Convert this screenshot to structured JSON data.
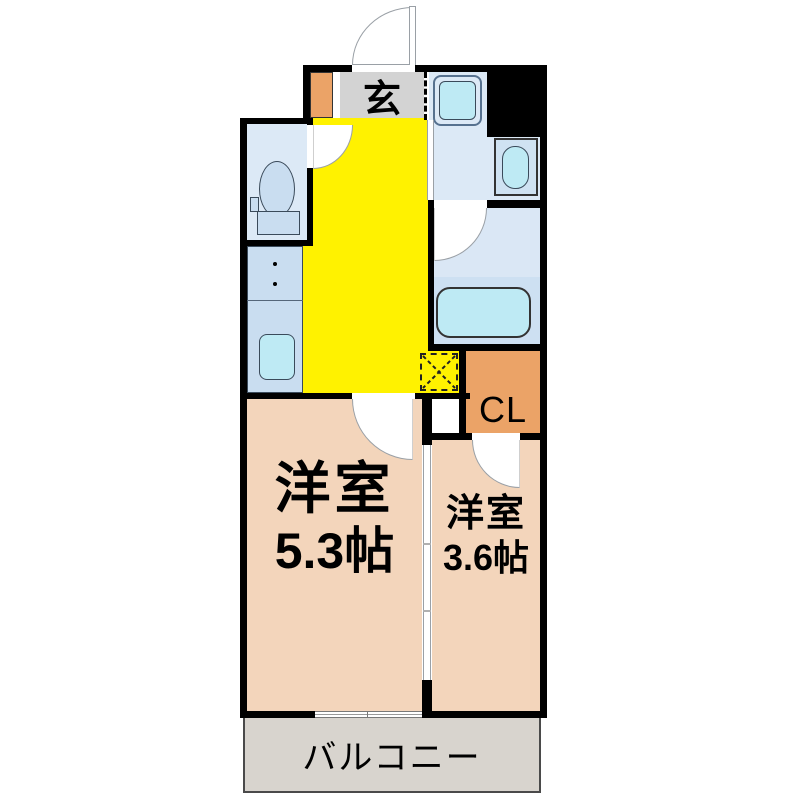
{
  "plan": {
    "type": "apartment-floor-plan",
    "labels": {
      "genkan": "玄",
      "closet": "CL",
      "room_main": {
        "name": "洋室",
        "size": "5.3帖"
      },
      "room_sub": {
        "name": "洋室",
        "size": "3.6帖"
      },
      "balcony": "バルコニー"
    },
    "fixtures": [
      "entry-door",
      "shoe-cabinet",
      "washing-machine-space",
      "pipe-space",
      "washbasin",
      "toilet",
      "gas-stove",
      "kitchen-sink",
      "bathtub",
      "refrigerator-space",
      "sliding-partition",
      "balcony-window"
    ],
    "colors": {
      "wall": "#000000",
      "hallway_kitchen": "#fff200",
      "rooms": "#f3d5bb",
      "wet_rooms": "#dce9f6",
      "fixtures": "#c9ddf0",
      "fixture_accent": "#beeaf4",
      "closet_and_entrance": "#eba367",
      "genkan_floor": "#d3d3d3",
      "balcony": "#d8d4ce"
    }
  }
}
